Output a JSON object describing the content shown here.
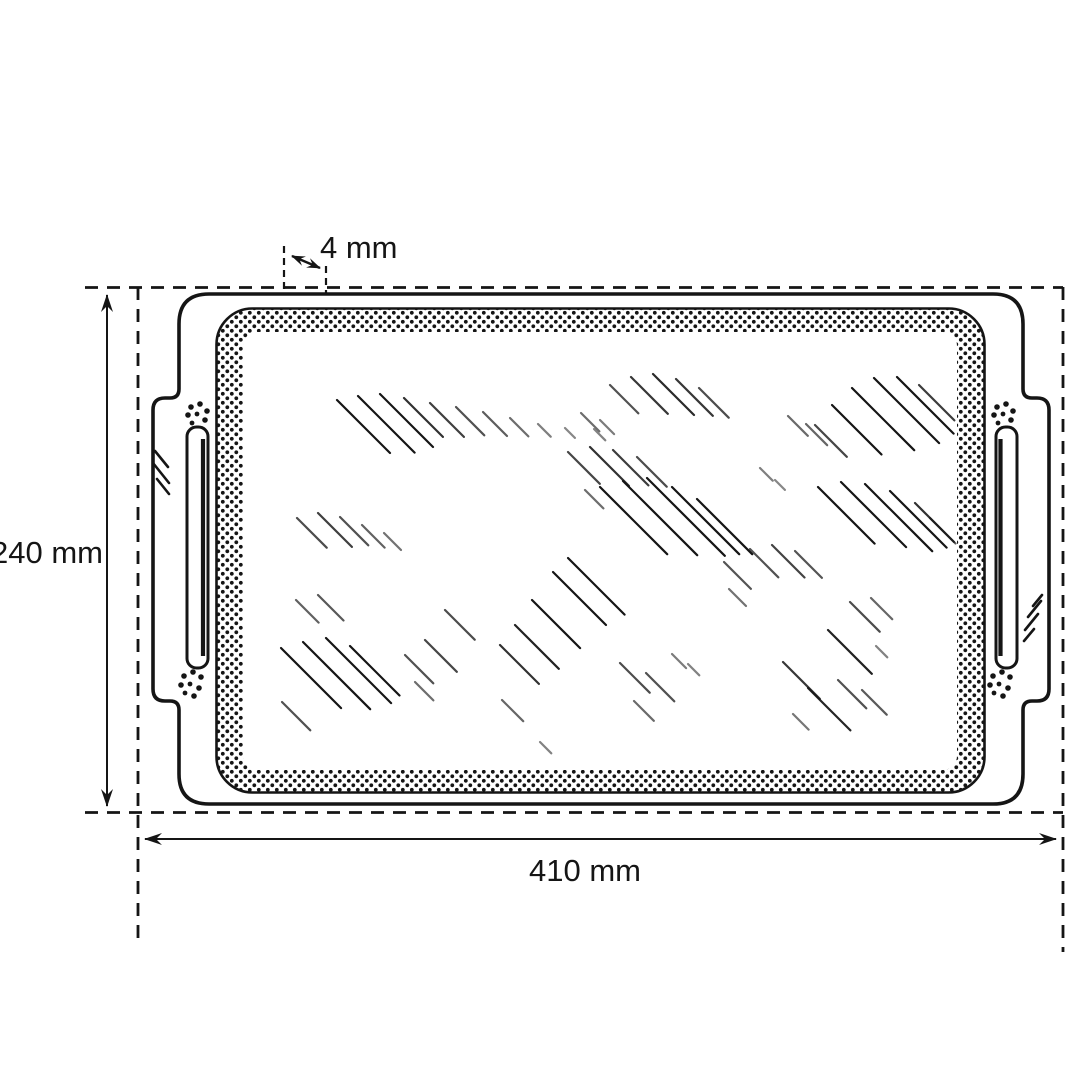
{
  "diagram": {
    "type": "technical-drawing",
    "subject": "serving-tray-top-view",
    "dimensions": {
      "height": {
        "label": "240 mm"
      },
      "width": {
        "label": "410 mm"
      },
      "rim": {
        "label": "4 mm"
      }
    },
    "colors": {
      "line": "#151515",
      "background": "#ffffff"
    }
  }
}
